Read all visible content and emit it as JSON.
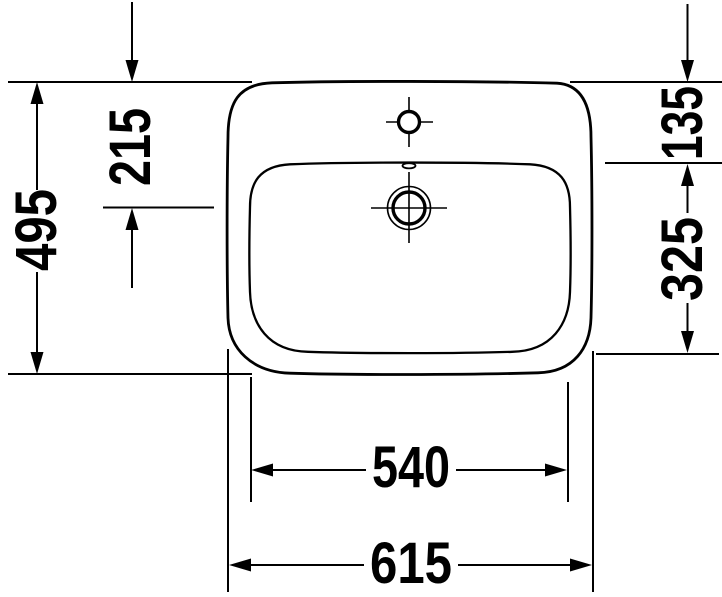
{
  "drawing": {
    "subject": "washbasin-plan-view-technical-drawing",
    "background_color": "#ffffff",
    "line_color": "#000000",
    "labels": {
      "overall_depth": "495",
      "drain_center_offset": "215",
      "rim_to_bowl": "135",
      "bowl_depth": "325",
      "bowl_width": "540",
      "overall_width": "615"
    }
  }
}
